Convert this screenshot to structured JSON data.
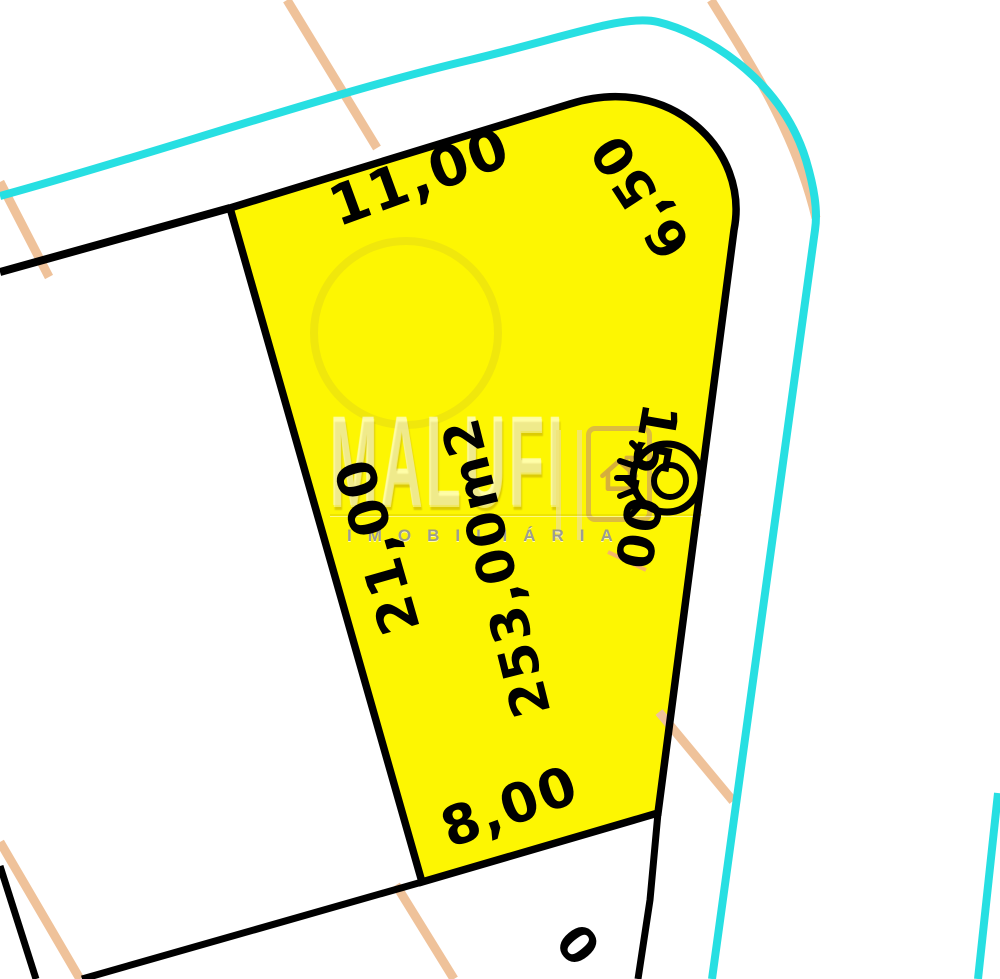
{
  "map": {
    "lot": {
      "area_label": "253,00m2",
      "dimensions": {
        "top": "11,00",
        "corner": "6,50",
        "left": "21,00",
        "right": "15,00",
        "bottom": "8,00"
      },
      "adjacent_lot_partial_label": "0"
    },
    "watermark": {
      "brand": "MALUFI",
      "subtitle": "IMOBILIÁRIA"
    },
    "colors": {
      "lot_fill": "#fdf602",
      "boundary": "#000000",
      "road_edge": "#27dfe2",
      "guide_line": "#efc29a",
      "marker_pink": "#f2a08e",
      "watermark_gold": "#d4ac3e"
    }
  }
}
